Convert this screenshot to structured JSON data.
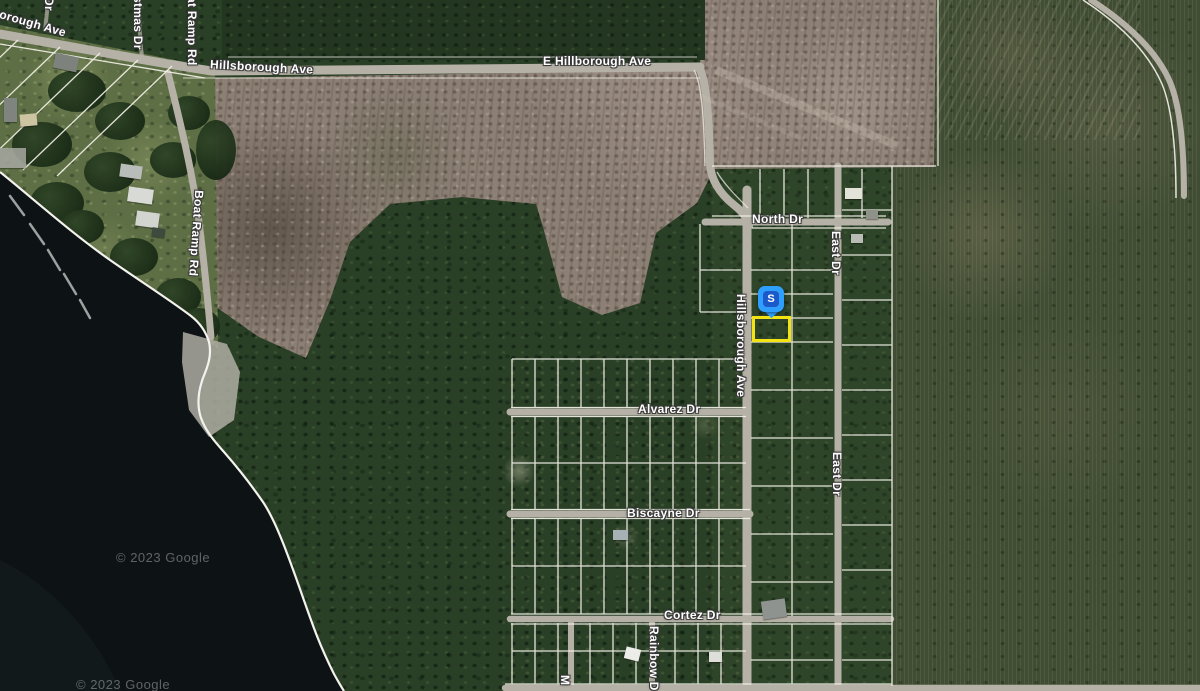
{
  "map": {
    "type_note": "satellite map with street labels",
    "labels": {
      "borough_ave": "borough Ave",
      "dr_partial": "Dr",
      "stmas_dr": "stmas Dr",
      "at_ramp_rd": "at Ramp Rd",
      "hillsborough_ave_w": "Hillsborough Ave",
      "e_hillborough_ave": "E Hillborough Ave",
      "boat_ramp_rd": "Boat Ramp Rd",
      "north_dr": "North Dr",
      "east_dr_upper": "East Dr",
      "east_dr_lower": "East Dr",
      "hillsborough_ave_v": "Hillsborough Ave",
      "alvarez_dr": "Alvarez Dr",
      "biscayne_dr": "Biscayne Dr",
      "cortez_dr": "Cortez Dr",
      "rainbow_dr_partial": "Rainbow D",
      "m_partial": "M"
    },
    "marker": {
      "text": "S",
      "color": "#2f9fff",
      "inner_color": "#1b59c9"
    },
    "selection": {
      "outline_color": "#f3e312"
    },
    "watermarks": {
      "upper": "© 2023 Google",
      "lower": "© 2023 Google"
    },
    "colors": {
      "water": "#0d1215",
      "forest": "#2a4026",
      "cleared_field": "#8c7f74",
      "road": "#b6b1a6",
      "parcel_line": "#f4f1e9"
    }
  }
}
